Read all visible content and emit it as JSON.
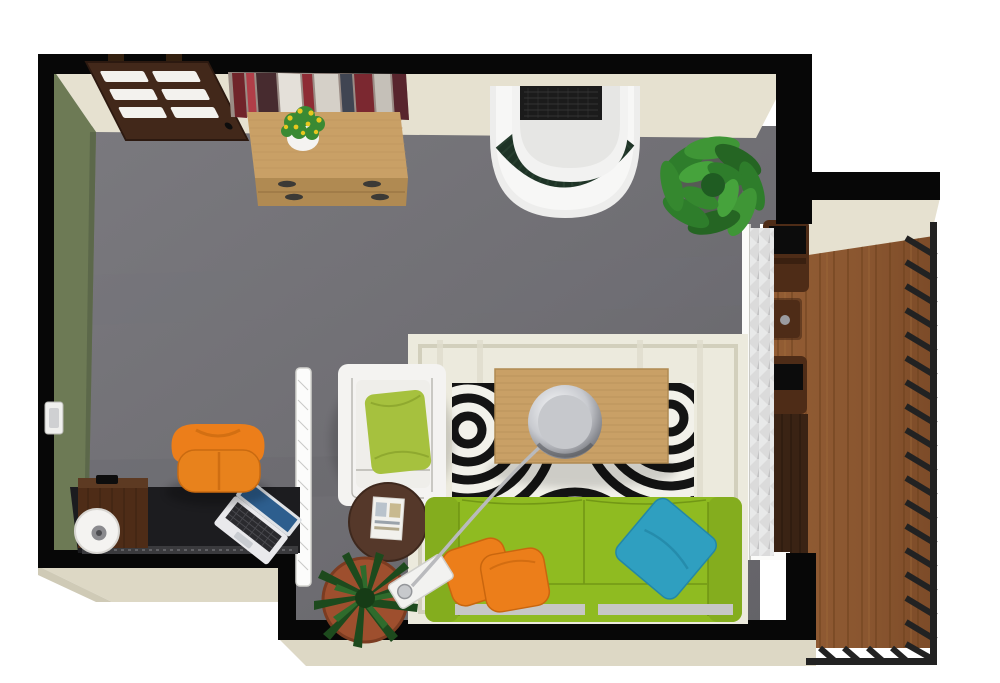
{
  "meta": {
    "type": "3d-floor-plan-render",
    "view": "top-down 3D dollhouse view",
    "rooms": [
      "home-office",
      "living-room",
      "balcony"
    ]
  },
  "palette": {
    "floor": "#6f6e73",
    "floorLight": "#7d7c81",
    "wallBlack": "#070707",
    "wallCream": "#e6e1d0",
    "wallGreen": "#6d7a55",
    "ledge": "#ddd8c5",
    "doorWood": "#42281a",
    "woodLight": "#c9a066",
    "woodMid": "#8a5630",
    "woodDark": "#4e2c17",
    "deckLine": "#6f431f",
    "sofaGreen": "#8fbb21",
    "pillowGreen": "#a6c13e",
    "accentOrange": "#ec7e1a",
    "accentTeal": "#2f9fc0",
    "rugCream": "#eceadd",
    "rugBorder": "#d2cfbc",
    "zebraBlack": "#141414",
    "zebraWhite": "#f2f1ea",
    "whiteFurniture": "#f4f3f1",
    "chrome": "#b9babd",
    "plantGreen": "#3a8a33",
    "plantDark": "#1d4a1d",
    "marbleGreen": "#1e3326",
    "curtain": "#d9d9d9",
    "deskBlack": "#1c1c1f",
    "terracotta": "#9e4f2e",
    "railing": "#222222",
    "laptopBlue": "#2d5e8e",
    "grille": "#1b1b1b"
  },
  "objects": {
    "entryDoor": {
      "label": "Entry door with glass slats"
    },
    "wallArt": {
      "label": "Abstract wall art"
    },
    "sideboard": {
      "label": "Wooden sideboard with drawers"
    },
    "flowerPot": {
      "label": "Yellow flowers in white pot"
    },
    "curvedCabinet": {
      "label": "Curved white cabinet with grille and marble band"
    },
    "plantLarge": {
      "label": "Large potted plant"
    },
    "wallLight": {
      "label": "Wall-mounted fixture"
    },
    "desk": {
      "label": "Black office desk"
    },
    "deskCabinet": {
      "label": "Walnut desk organizer"
    },
    "deskDispenser": {
      "label": "Round white desk accessory"
    },
    "laptop": {
      "label": "Open laptop"
    },
    "officeChair": {
      "label": "Orange office chair"
    },
    "glassPartition": {
      "label": "Glass partition screen"
    },
    "armchair": {
      "label": "White armchair"
    },
    "pillowGreen": {
      "label": "Green throw pillow"
    },
    "sideTable": {
      "label": "Round walnut side table"
    },
    "magazine": {
      "label": "Magazine"
    },
    "rugCream": {
      "label": "Cream area rug"
    },
    "rugZebra": {
      "label": "Zebra print rug"
    },
    "coffeeTable": {
      "label": "Wooden coffee table"
    },
    "arcLamp": {
      "label": "Chrome arc floor lamp"
    },
    "sofa": {
      "label": "Lime green 3-seat sofa"
    },
    "pillowsOrange": {
      "label": "Two orange throw pillows"
    },
    "pillowTeal": {
      "label": "Teal throw pillow"
    },
    "fern": {
      "label": "Potted fern"
    },
    "curtain": {
      "label": "Floor-length curtain"
    },
    "windowWall": {
      "label": "Glass wall to balcony"
    },
    "balconyDeck": {
      "label": "Balcony wood decking"
    },
    "outdoorChairA": {
      "label": "Outdoor chair"
    },
    "outdoorTable": {
      "label": "Outdoor side table"
    },
    "outdoorChairB": {
      "label": "Outdoor chair"
    },
    "privacyScreen": {
      "label": "Dark privacy screen"
    },
    "railing": {
      "label": "Balcony railing"
    }
  }
}
